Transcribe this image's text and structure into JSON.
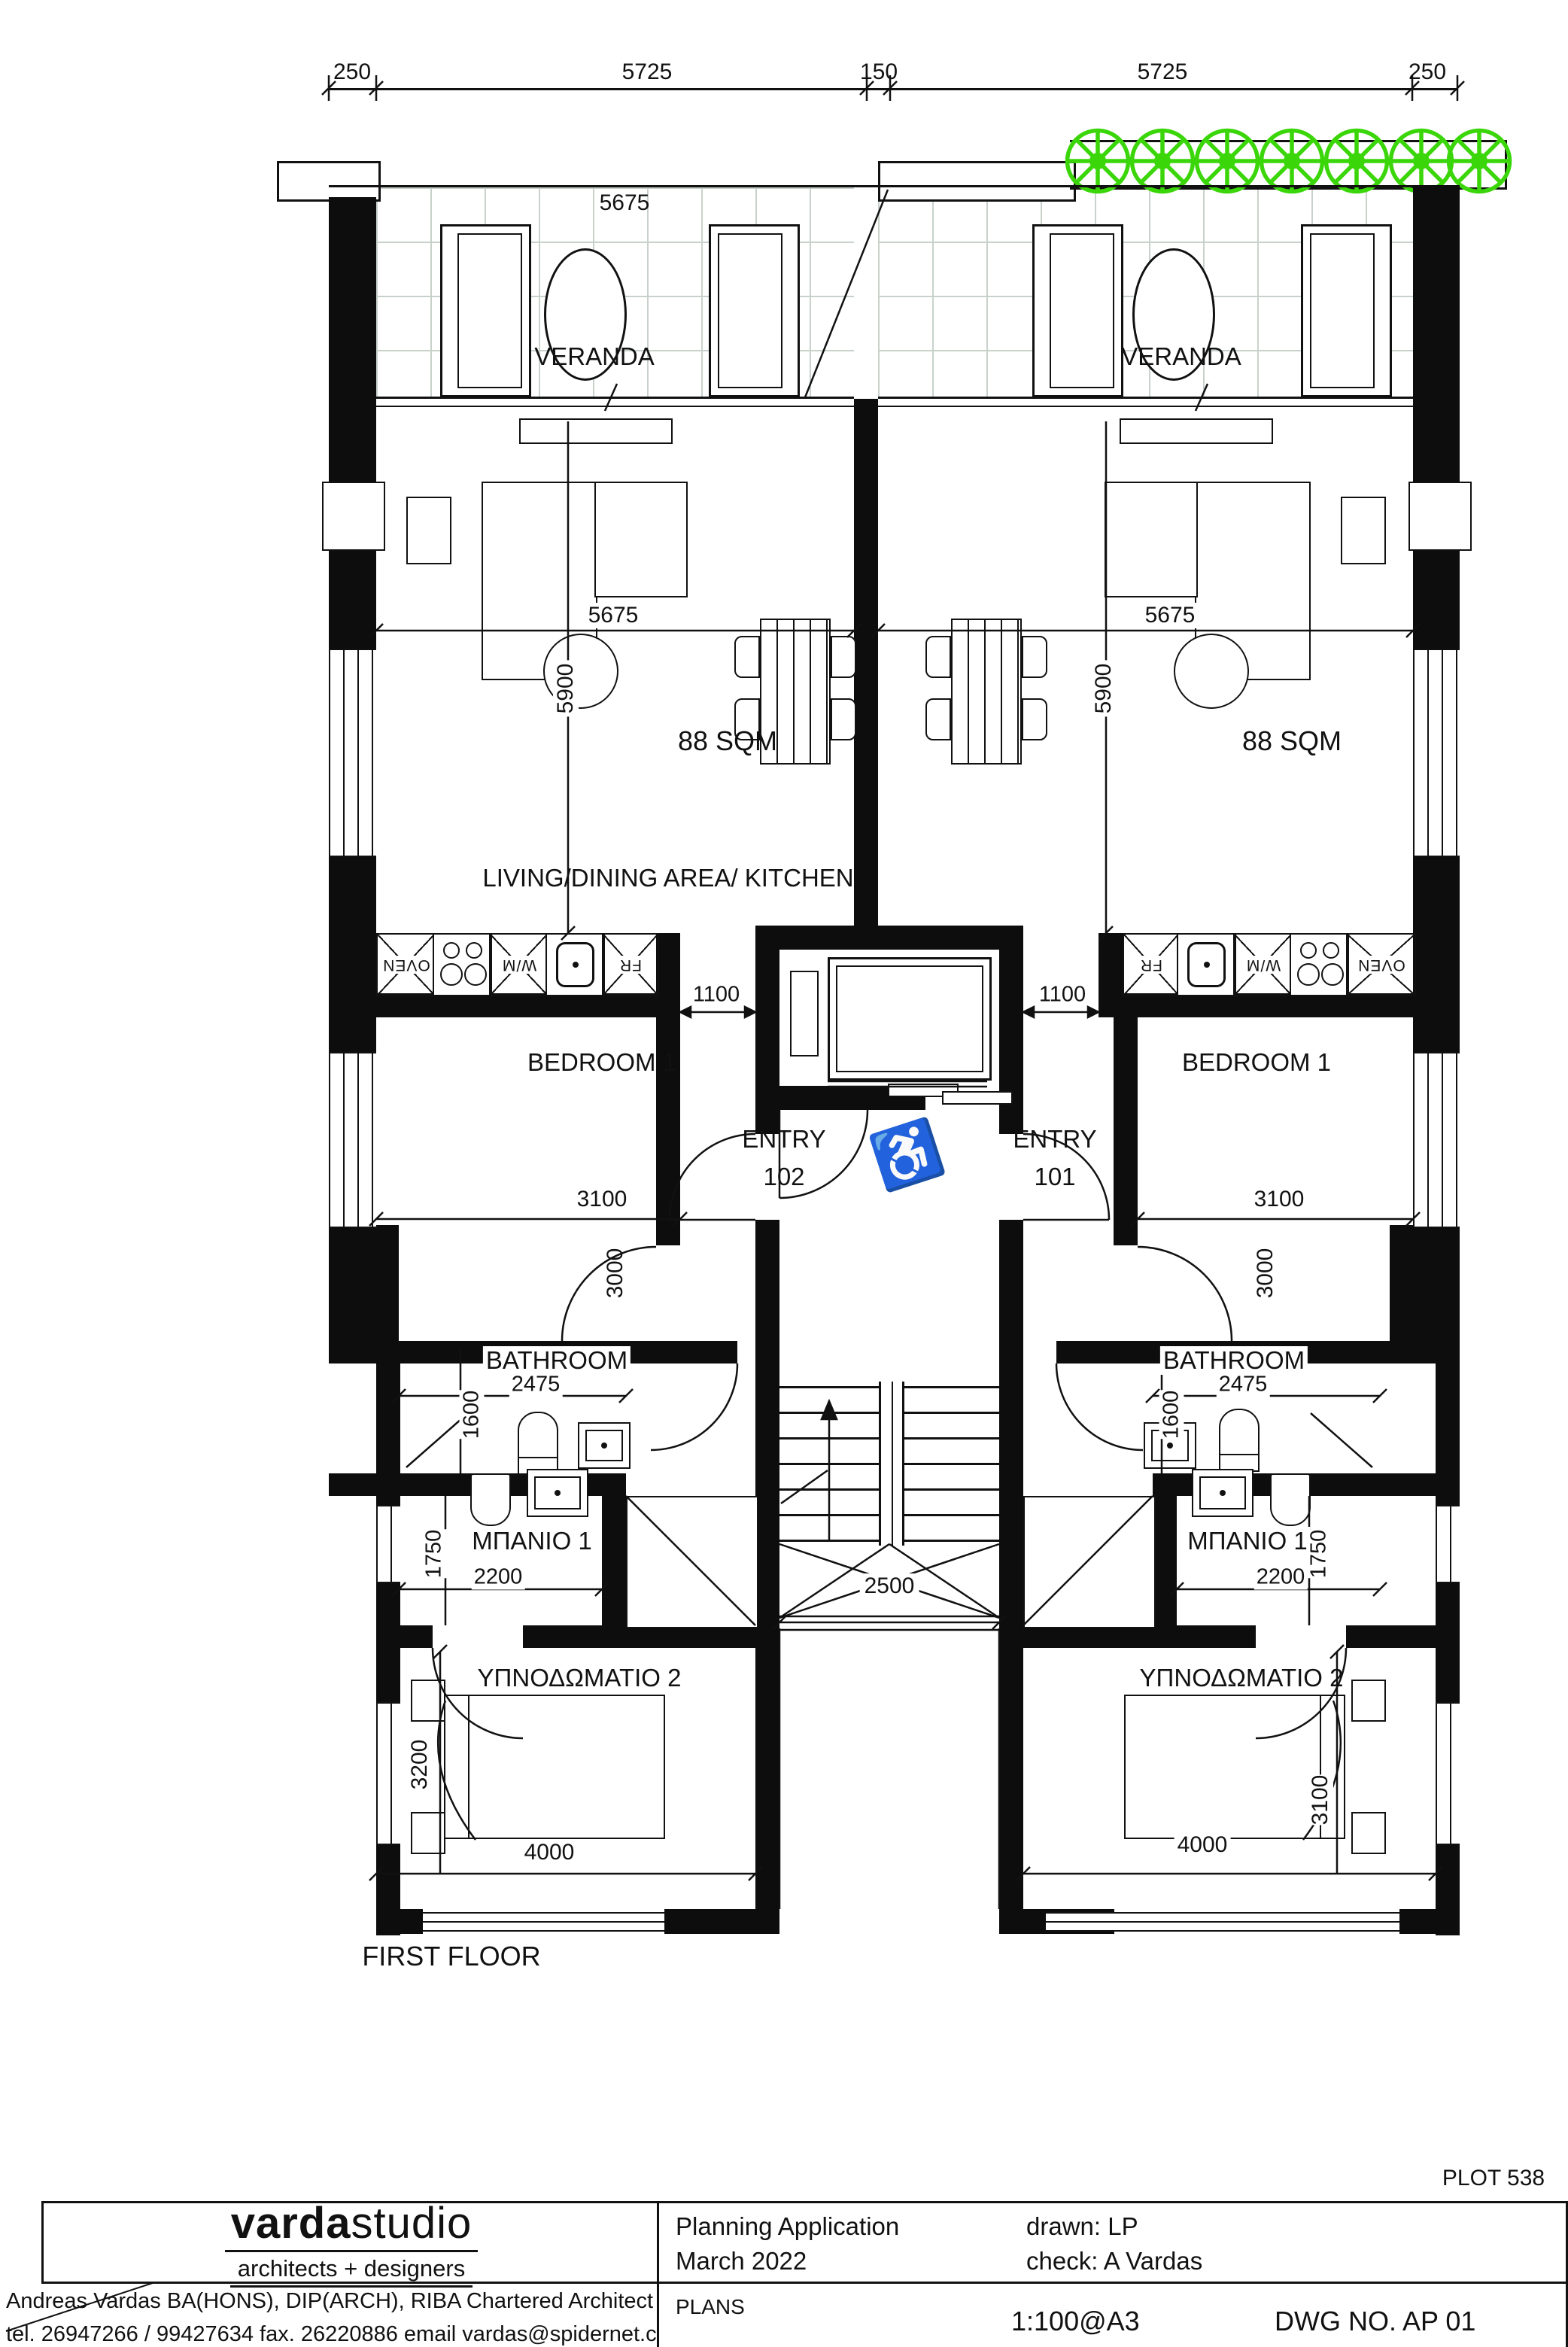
{
  "page": {
    "floor_label": "FIRST FLOOR",
    "plot": "PLOT 538"
  },
  "dims": {
    "top": [
      "250",
      "5725",
      "150",
      "5725",
      "250"
    ],
    "veranda_width": "5675",
    "living_width": "5675",
    "living_height": "5900",
    "area": "88 SQM",
    "hall": "1100",
    "bedroom1_width": "3100",
    "bedroom1_height": "3000",
    "bathroom_width": "2475",
    "bathroom_height": "1600",
    "wc_width": "2200",
    "wc_height": "1750",
    "bedroom2_width": "4000",
    "bedroom2_height_left": "3200",
    "bedroom2_height_right": "3100",
    "stair_width": "2500"
  },
  "rooms": {
    "veranda": "VERANDA",
    "living": "LIVING/DINING AREA/ KITCHEN",
    "bedroom1": "BEDROOM 1",
    "bathroom": "BATHROOM",
    "wc": "ΜΠΑΝΙΟ 1",
    "bedroom2": "ΥΠΝΟΔΩΜΑΤΙΟ 2",
    "entry": "ENTRY",
    "entry_left_no": "102",
    "entry_right_no": "101"
  },
  "appliances": {
    "oven": "OVEN",
    "wm": "W/M",
    "fr": "FR"
  },
  "titleblock": {
    "studio_bold": "varda",
    "studio_light": "studio",
    "studio_sub": "architects + designers",
    "architect": "Andreas Vardas BA(HONS), DIP(ARCH), RIBA Chartered Architect",
    "contact": "tel. 26947266 / 99427634 fax. 26220886 email vardas@spidernet.com.cy",
    "application": "Planning Application",
    "date": "March 2022",
    "drawn": "drawn: LP",
    "check": "check: A Vardas",
    "plans": "PLANS",
    "scale": "1:100@A3",
    "dwg": "DWG NO. AP 01"
  },
  "colors": {
    "wall": "#0d0d0d",
    "tree_green": "#3bd60a",
    "tile_grid": "#c8d2cb"
  }
}
